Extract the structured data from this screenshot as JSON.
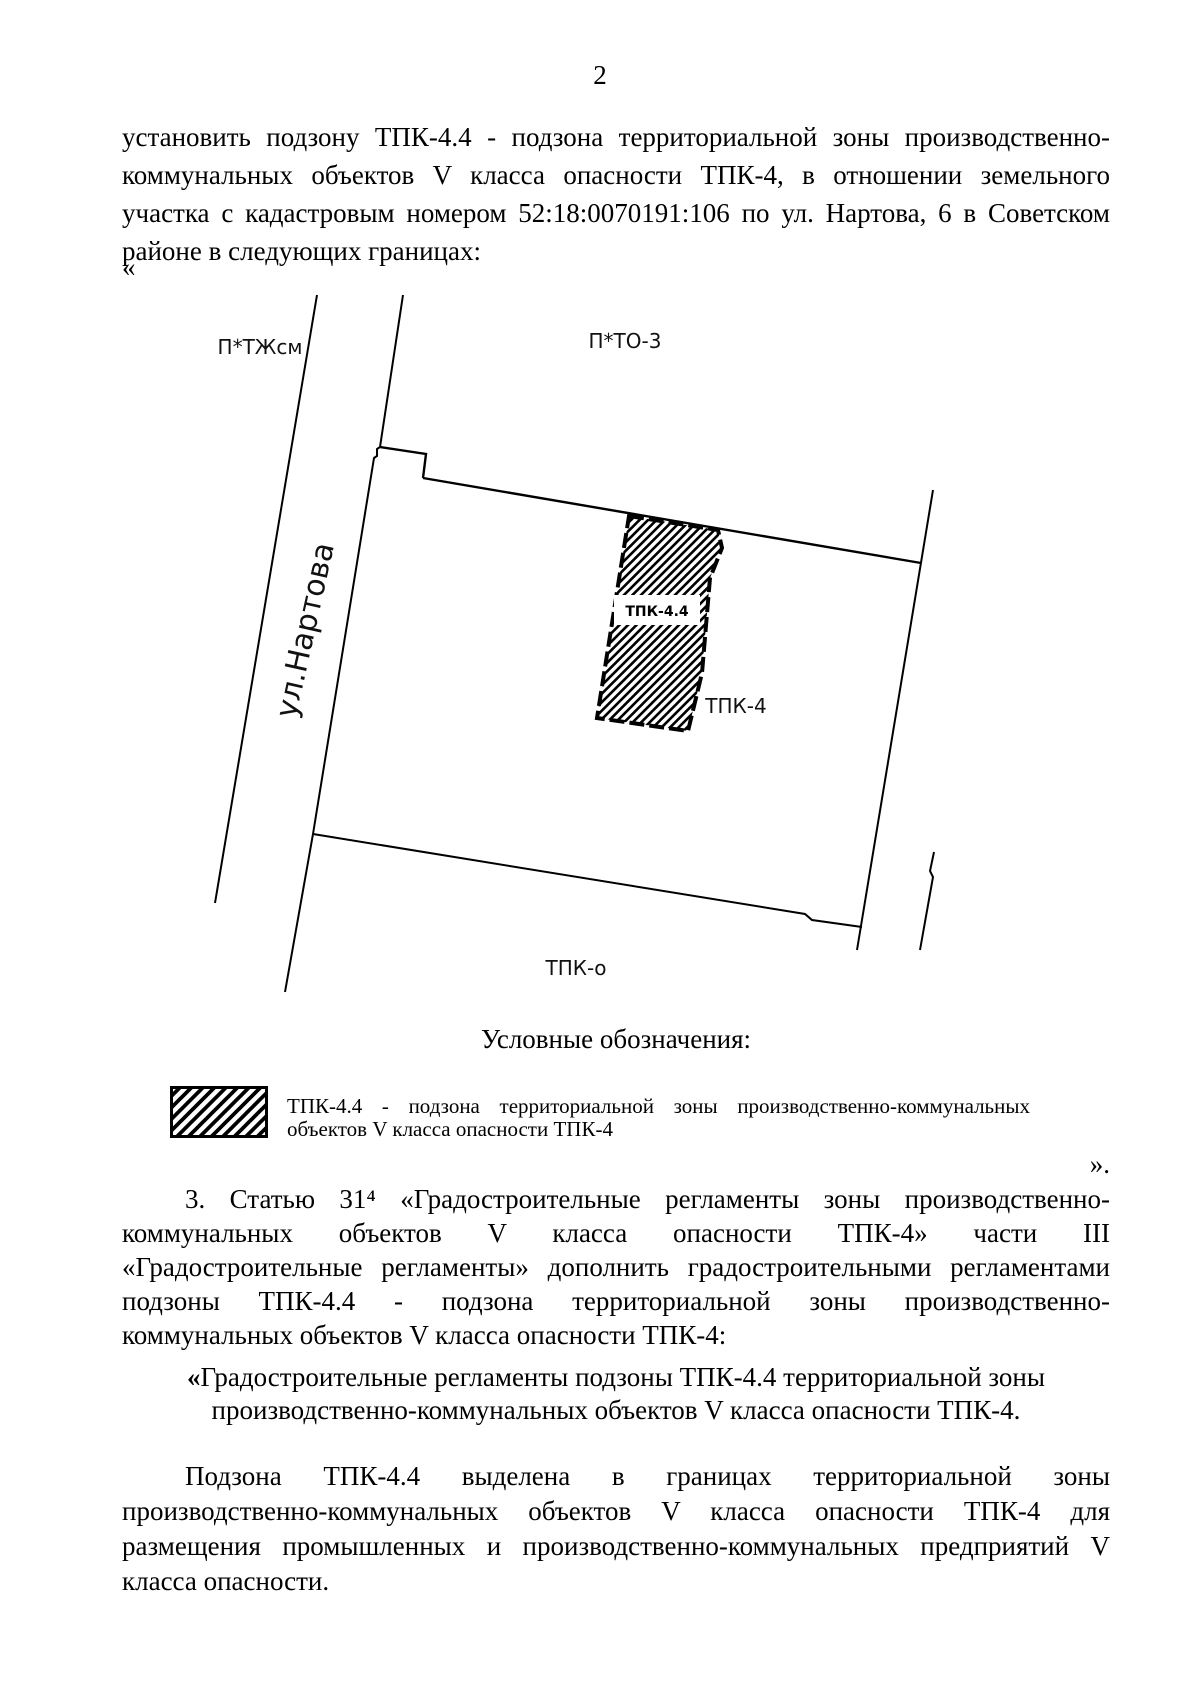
{
  "page": {
    "number": "2",
    "background_color": "#ffffff",
    "text_color": "#000000"
  },
  "quotes": {
    "open": "«",
    "close": "»."
  },
  "para1": {
    "lines": [
      "установить подзону ТПК-4.4 - подзона территориальной зоны производственно-",
      "коммунальных объектов V класса опасности ТПК-4, в отношении земельного",
      "участка с кадастровым номером 52:18:0070191:106 по ул. Нартова, 6 в Советском",
      "районе в следующих границах:"
    ]
  },
  "map": {
    "labels": {
      "zone_top_left": "П*ТЖсм",
      "zone_top_right": "П*ТО-3",
      "street": "ул.Нартова",
      "subzone": "ТПК-4.4",
      "zone_main": "ТПК-4",
      "zone_bottom": "ТПК-о"
    },
    "line_color": "#000000",
    "hatch_color": "#000000"
  },
  "legend": {
    "heading": "Условные обозначения:",
    "item": {
      "lines": [
        "ТПК-4.4 - подзона территориальной зоны производственно-коммунальных",
        "объектов V класса опасности ТПК-4"
      ]
    }
  },
  "para3": {
    "lines": [
      "3. Статью 31⁴ «Градостроительные регламенты зоны производственно-",
      "коммунальных объектов V класса опасности ТПК-4» части III",
      "«Градостроительные регламенты» дополнить градостроительными регламентами",
      "подзоны ТПК-4.4 - подзона территориальной зоны производственно-",
      "коммунальных объектов V класса опасности ТПК-4:"
    ]
  },
  "quote_block": {
    "open_mark": "«",
    "line1_rest": "Градостроительные регламенты подзоны ТПК-4.4 территориальной зоны",
    "line2": "производственно-коммунальных объектов V класса опасности ТПК-4."
  },
  "para4": {
    "lines": [
      "Подзона ТПК-4.4 выделена в границах территориальной зоны",
      "производственно-коммунальных объектов V класса опасности ТПК-4 для",
      "размещения промышленных и производственно-коммунальных предприятий V",
      "класса опасности."
    ]
  }
}
